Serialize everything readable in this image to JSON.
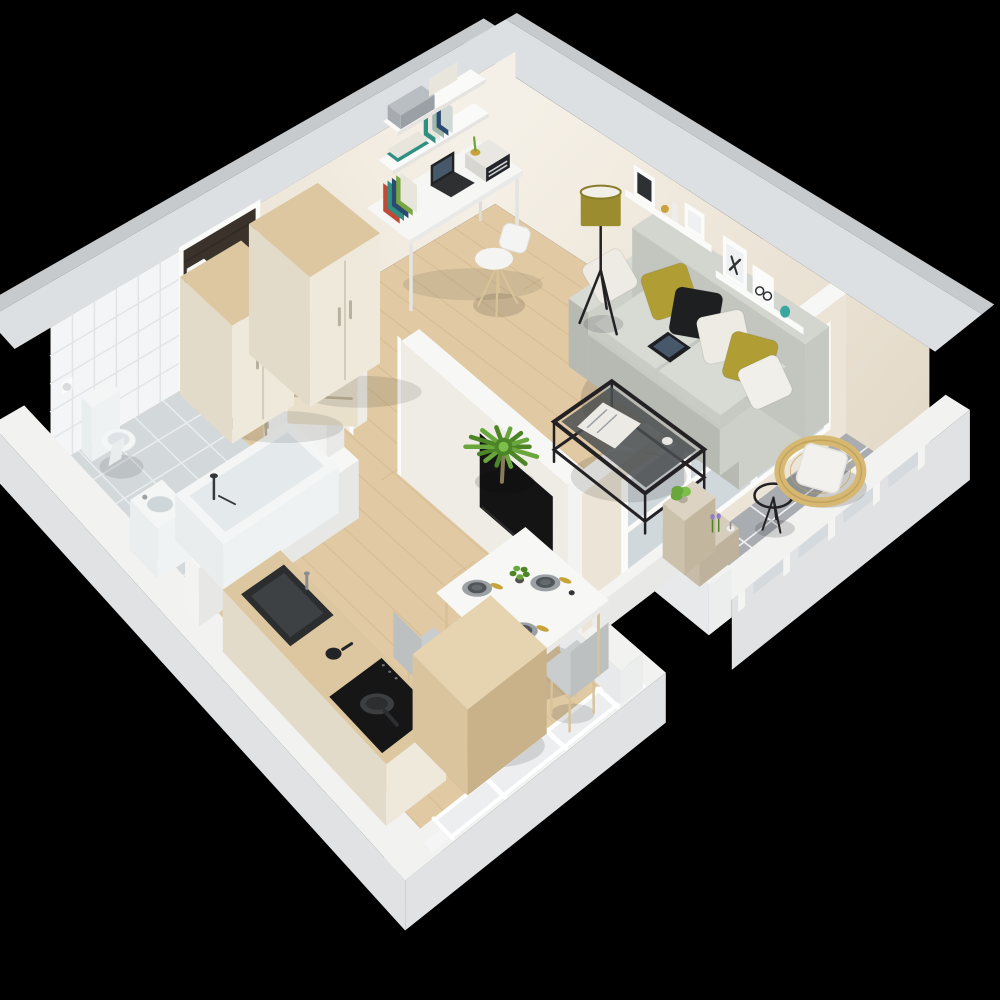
{
  "scene": {
    "description": "3D isometric cutaway floor plan render of a one-room apartment on a black background",
    "background_color": "#000000",
    "rooms": [
      {
        "name": "entry-hall",
        "floor": "light wood"
      },
      {
        "name": "bathroom",
        "floor": "grey tile"
      },
      {
        "name": "kitchen",
        "floor": "light wood"
      },
      {
        "name": "dining-area",
        "floor": "light wood"
      },
      {
        "name": "living-room",
        "floor": "light wood"
      },
      {
        "name": "study-corner",
        "floor": "light wood"
      },
      {
        "name": "balcony",
        "floor": "grey tile"
      }
    ],
    "inventory": {
      "entry_hall": [
        "front-door",
        "doormat",
        "wardrobe",
        "wardrobe",
        "interior-door"
      ],
      "bathroom": [
        "toilet",
        "toilet-paper-holder",
        "washbasin",
        "bathtub",
        "bathroom-door",
        "tiled-wall"
      ],
      "kitchen": [
        "kitchen-counter",
        "sink",
        "moka-pot",
        "induction-cooktop",
        "frying-pan",
        "wooden-island-cube",
        "kitchen-window"
      ],
      "dining_area": [
        "dining-table",
        "chair",
        "chair",
        "chair",
        "place-setting",
        "place-setting",
        "place-setting",
        "centerpiece-plant"
      ],
      "living_room": [
        "sofa",
        "cushions",
        "tablet",
        "coffee-table",
        "magazine",
        "floor-lamp",
        "wall-shelf-with-frames",
        "tv-panel",
        "palm-plant",
        "balcony-window"
      ],
      "study_corner": [
        "desk",
        "desk-chair",
        "laptop",
        "radio",
        "books",
        "wall-shelves"
      ],
      "balcony": [
        "rattan-chair",
        "side-table",
        "plant-shelf",
        "potted-plant",
        "lavender",
        "candle",
        "railing"
      ]
    },
    "counts": {
      "wardrobes": 2,
      "dining_chairs": 3,
      "place_settings": 3,
      "sofa_cushions": 6,
      "railing_posts": 5
    }
  },
  "palette": {
    "background": "#000000",
    "wall_top": "#dde0e3",
    "wall_top_outer": "#c6cacd",
    "wall_cream_light": "#f5f0e7",
    "wall_cream": "#ece5d7",
    "wall_cream_dark": "#e2d8c6",
    "wall_white": "#f3f3f1",
    "wall_white_top": "#f7f7f6",
    "low_wall_top": "#f2f2f1",
    "low_wall_outer": "#e0e2e4",
    "floor_wood": "#e0c9a3",
    "floor_wood_line": "#b08651",
    "tile_bath_floor": "#d3d8db",
    "tile_bath_line": "#e9edef",
    "tile_wall": "#f3f5f6",
    "tile_wall_line": "#e1e5e8",
    "balcony_tile": "#a9adb2",
    "balcony_tile_line": "#eff1f2",
    "doormat": "#322c27",
    "front_door": "#3b322b",
    "door_wood": "#e9e0cc",
    "door_wood_line": "#b5a88c",
    "furniture_cream": "#efe9dc",
    "furniture_cream_side": "#e3dbc9",
    "furniture_wood_top": "#dcc7a0",
    "desk_white": "#f6f6f4",
    "shelf_white": "#fafaf8",
    "sofa_base": "#c7c9c3",
    "sofa_seat": "#d8dad4",
    "sofa_dark": "#b7b9b3",
    "sofa_front": "#cdcfc9",
    "pillow_olive": "#b09e35",
    "pillow_black": "#1e1f21",
    "pillow_white": "#edebe4",
    "lamp_shade": "#9a8c2f",
    "lamp_top": "#f1efe7",
    "metal_black": "#232124",
    "tv_black": "#141414",
    "tablet": "#1d1f22",
    "tablet_screen": "#46586a",
    "plant_green": "#69a73c",
    "plant_green_dark": "#4c8527",
    "plant_green_lite": "#7cbf4a",
    "plant_pot": "#b2ac9d",
    "table_white": "#f7f7f5",
    "chair_gray": "#c9cdce",
    "chair_gray_dark": "#bcc0c1",
    "chair_leg_wood": "#d8c298",
    "plate_dark": "#50555a",
    "plate_inner": "#646a6e",
    "placemat": "#9aa0a4",
    "napkin_yellow": "#c7a33a",
    "counter_sink": "#2b2d2f",
    "cooktop": "#161617",
    "pan": "#3c3e40",
    "pan_inner": "#2c2e2f",
    "red_dot": "#c0392b",
    "toilet_white": "#f4f6f6",
    "tub_inner": "#e4e9ec",
    "fixture_shadow": "#dde3e6",
    "rattan": "#d7b873",
    "rattan_dark": "#c2a35c",
    "cushion_white": "#f2f1ed",
    "lavender": "#8f7fc5",
    "candle": "#efeeea",
    "glass": "#ccd4d8",
    "frame_white": "#fbfbfa",
    "frame_inner": "#eef0f1",
    "art_dark": "#2e3134",
    "gold_decor": "#c9a23a",
    "teal_decor": "#3aa6a0",
    "book_colors_desk": [
      "#c04a38",
      "#2f8f83",
      "#2b4a6f",
      "#79a53e",
      "#e8e5dd"
    ],
    "book_colors_shelf": [
      "#2f8f83",
      "#e8e5dd",
      "#9fb7ad",
      "#2b4a6f",
      "#cfd8d4"
    ],
    "cushion_colors": [
      "#edebe4",
      "#b09e35",
      "#1e1f21",
      "#edebe4",
      "#b09e35",
      "#f0efe9"
    ],
    "paper_white": "#eceae4",
    "binder_gray": "#a6abaf",
    "radio_dark": "#23252a"
  }
}
